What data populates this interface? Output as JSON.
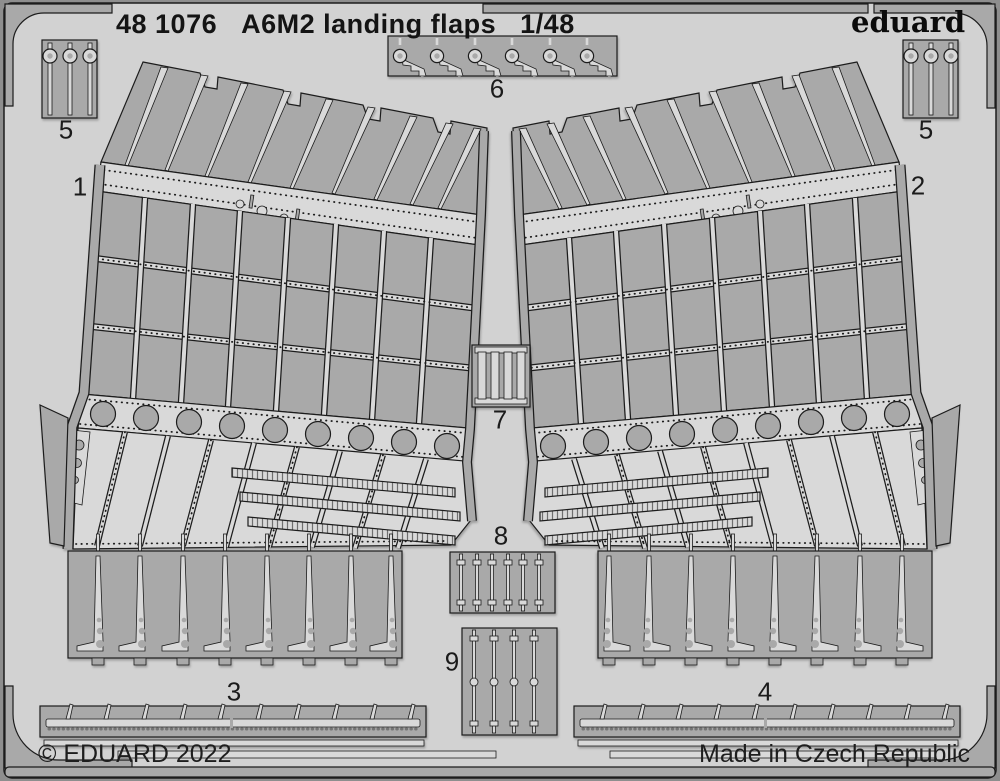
{
  "header": {
    "catalog_number": "48 1076",
    "title": "A6M2 landing flaps",
    "scale": "1/48"
  },
  "brand": {
    "logo_text": "eduard"
  },
  "footer": {
    "copyright": "© EDUARD 2022",
    "origin": "Made in Czech Republic"
  },
  "part_labels": {
    "p1": "1",
    "p2": "2",
    "p3": "3",
    "p4": "4",
    "p5_left": "5",
    "p5_right": "5",
    "p6": "6",
    "p7": "7",
    "p8": "8",
    "p9": "9"
  },
  "colors": {
    "sheet_light": "#d2d2d2",
    "part_light": "#d9d9d9",
    "etched_dark": "#a9a9a9",
    "outline": "#1c1c1c",
    "edge_gray": "#8e8e8e",
    "text_dark": "#141414"
  }
}
